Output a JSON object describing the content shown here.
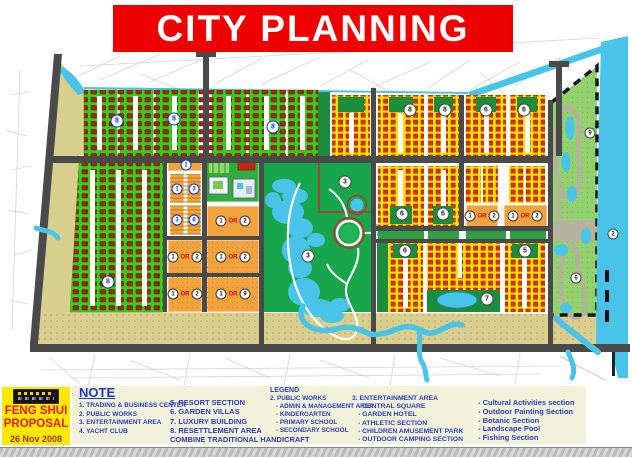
{
  "title": "CITY PLANNING",
  "proposal": {
    "line1": "FENG SHUI",
    "line2": "PROPOSAL",
    "date": "26 Nov 2008",
    "logo": "company-logo"
  },
  "note": {
    "title": "NOTE",
    "col1": [
      "1. TRADING & BUSINESS CENTER",
      "2. PUBLIC WORKS",
      "3. ENTERTAINMENT AREA",
      "4. YACHT  CLUB"
    ],
    "col2": [
      "5. RESORT SECTION",
      "6. GARDEN VILLAS",
      "7. LUXURY BUILDING",
      "8. RESETTLEMENT AREA",
      "COMBINE TRADITIONAL HANDICRAFT"
    ]
  },
  "legend": {
    "title": "LEGEND",
    "public_works": {
      "head": "2. PUBLIC WORKS",
      "items": [
        "- ADMIN & MANAGEMENT AREA",
        "- KINDERGARTEN",
        "- PRIMARY SCHOOL",
        "- SECONDARY SCHOOL"
      ]
    },
    "entertainment": {
      "head": "3. ENTERTAINMENT AREA",
      "items": [
        "- CENTRAL SQUARE",
        "- GARDEN HOTEL",
        "- ATHLETIC SECTION",
        "- CHILDREN AMUSEMENT PARK",
        "- OUTDOOR CAMPING  SECTION"
      ]
    },
    "extra": {
      "items": [
        "- Cultural Activities section",
        "- Outdoor Painting Section",
        "- Botanic Section",
        "- Landscape Pool",
        "- Fishing Section"
      ]
    }
  },
  "map": {
    "or_label": "OR",
    "labels": [
      {
        "x": 117,
        "y": 121,
        "t": "8",
        "c": "lb"
      },
      {
        "x": 174,
        "y": 119,
        "t": "8",
        "c": "lb"
      },
      {
        "x": 273,
        "y": 127,
        "t": "8",
        "c": "lb"
      },
      {
        "x": 108,
        "y": 282,
        "t": "8",
        "c": "lb"
      },
      {
        "x": 410,
        "y": 110,
        "t": "8",
        "c": "ld"
      },
      {
        "x": 445,
        "y": 110,
        "t": "8",
        "c": "ld"
      },
      {
        "x": 486,
        "y": 110,
        "t": "6",
        "c": "ld"
      },
      {
        "x": 524,
        "y": 110,
        "t": "6",
        "c": "ld"
      },
      {
        "x": 402,
        "y": 214,
        "t": "6",
        "c": "ld"
      },
      {
        "x": 443,
        "y": 214,
        "t": "6",
        "c": "ld"
      },
      {
        "x": 405,
        "y": 251,
        "t": "6",
        "c": "ld"
      },
      {
        "x": 525,
        "y": 251,
        "t": "5",
        "c": "ld"
      },
      {
        "x": 487,
        "y": 299,
        "t": "7",
        "c": "ld"
      },
      {
        "x": 345,
        "y": 182,
        "t": "3",
        "c": "ld"
      },
      {
        "x": 308,
        "y": 256,
        "t": "3",
        "c": "ld"
      },
      {
        "x": 590,
        "y": 133,
        "t": "9",
        "c": "ld ls"
      },
      {
        "x": 576,
        "y": 278,
        "t": "6",
        "c": "ld ls"
      },
      {
        "x": 613,
        "y": 234,
        "t": "2",
        "c": "ld ls"
      },
      {
        "x": 186,
        "y": 165,
        "t": "1",
        "c": "lb ls"
      },
      {
        "x": 177,
        "y": 189,
        "t": "1",
        "c": "lb ls"
      },
      {
        "x": 194,
        "y": 189,
        "t": "3",
        "c": "lb ls"
      },
      {
        "x": 177,
        "y": 220,
        "t": "3",
        "c": "lb ls"
      },
      {
        "x": 194,
        "y": 220,
        "t": "6",
        "c": "lb ls"
      }
    ],
    "or_blocks": [
      {
        "x": 185,
        "y": 257,
        "n1": "1",
        "n2": "2"
      },
      {
        "x": 185,
        "y": 294,
        "n1": "1",
        "n2": "2"
      },
      {
        "x": 233,
        "y": 221,
        "n1": "1",
        "n2": "2"
      },
      {
        "x": 233,
        "y": 257,
        "n1": "1",
        "n2": "2"
      },
      {
        "x": 233,
        "y": 294,
        "n1": "1",
        "n2": "9"
      },
      {
        "x": 482,
        "y": 216,
        "n1": "1",
        "n2": "2"
      },
      {
        "x": 525,
        "y": 216,
        "n1": "1",
        "n2": "2"
      }
    ]
  },
  "colors": {
    "banner_red": "#ee0000",
    "water_cyan": "#49c4e8",
    "housing_green": "#3ecb14",
    "park_green": "#17a64b",
    "block_yellow": "#ffdf00",
    "block_orange": "#f2a33d",
    "khaki": "#d8cf8e",
    "road_gray": "#4a4a4a",
    "note_blue": "#2a3cc0",
    "proposal_yellow": "#ffe800",
    "proposal_red": "#e81c1c"
  }
}
